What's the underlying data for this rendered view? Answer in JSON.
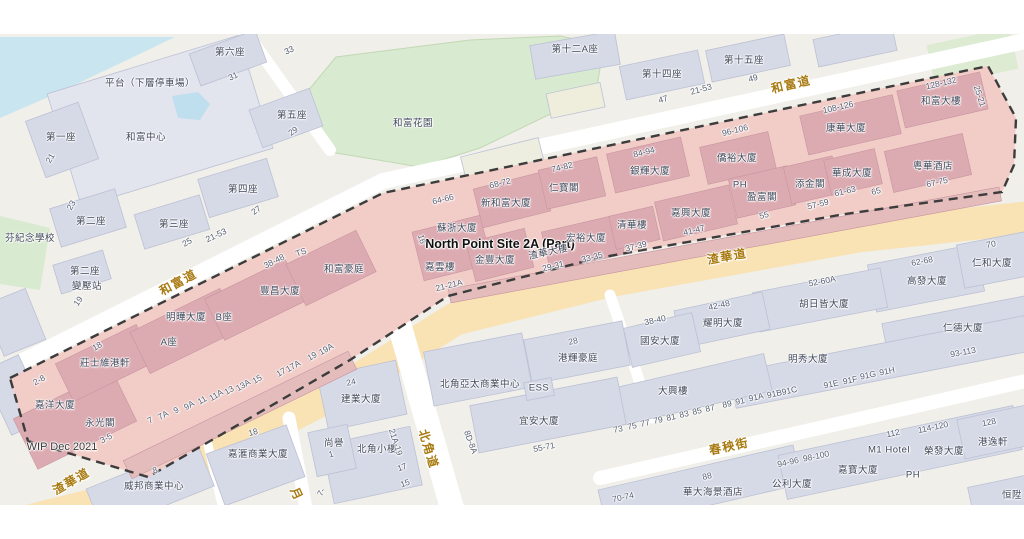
{
  "site": {
    "name": "North Point Site 2A (Part)",
    "wip_note": "WIP Dec 2021"
  },
  "colors": {
    "site_fill": "#f2cdc7",
    "site_building": "#dcabb1",
    "boundary_dash": "#3c3c3c",
    "road_label": "#a87a10",
    "building_label": "#3f4759",
    "main_road": "#f9e2b3",
    "water": "#c9e6f0",
    "park": "#d8eacf",
    "building": "#d6d9e6"
  },
  "roads": [
    {
      "t": "和富道",
      "x": 178,
      "y": 282,
      "r": -28,
      "c": "r"
    },
    {
      "t": "和富道",
      "x": 791,
      "y": 84,
      "r": -13,
      "c": "r"
    },
    {
      "t": "渣華道",
      "x": 71,
      "y": 481,
      "r": -30,
      "c": "r"
    },
    {
      "t": "渣華道",
      "x": 727,
      "y": 256,
      "r": -10,
      "c": "r"
    },
    {
      "t": "北角道",
      "x": 429,
      "y": 449,
      "r": 73,
      "c": "r"
    },
    {
      "t": "春秧街",
      "x": 729,
      "y": 446,
      "r": -12,
      "c": "r"
    },
    {
      "t": "月",
      "x": 297,
      "y": 494,
      "r": 65,
      "c": "r"
    }
  ],
  "buildings": [
    {
      "t": "第一座",
      "x": 61,
      "y": 136,
      "r": 0,
      "c": "b"
    },
    {
      "t": "和富中心",
      "x": 146,
      "y": 136,
      "r": 0,
      "c": "b"
    },
    {
      "t": "平台（下層停車場）",
      "x": 150,
      "y": 82,
      "r": 0,
      "c": "b"
    },
    {
      "t": "第六座",
      "x": 230,
      "y": 51,
      "r": 0,
      "c": "b"
    },
    {
      "t": "第五座",
      "x": 292,
      "y": 114,
      "r": 0,
      "c": "b"
    },
    {
      "t": "第四座",
      "x": 243,
      "y": 188,
      "r": 0,
      "c": "b"
    },
    {
      "t": "第二座",
      "x": 91,
      "y": 220,
      "r": 0,
      "c": "b"
    },
    {
      "t": "第三座",
      "x": 174,
      "y": 223,
      "r": 0,
      "c": "b"
    },
    {
      "t": "芬紀念學校",
      "x": 30,
      "y": 237,
      "r": 0,
      "c": "b"
    },
    {
      "t": "第二座",
      "x": 85,
      "y": 270,
      "r": 0,
      "c": "b"
    },
    {
      "t": "變壓站",
      "x": 87,
      "y": 285,
      "r": 0,
      "c": "b"
    },
    {
      "t": "和富花園",
      "x": 413,
      "y": 122,
      "r": 0,
      "c": "b"
    },
    {
      "t": "第十二A座",
      "x": 575,
      "y": 48,
      "r": 0,
      "c": "b"
    },
    {
      "t": "第十四座",
      "x": 662,
      "y": 73,
      "r": 0,
      "c": "b"
    },
    {
      "t": "第十五座",
      "x": 744,
      "y": 59,
      "r": 0,
      "c": "b"
    },
    {
      "t": "康華大廈",
      "x": 846,
      "y": 127,
      "r": 0,
      "c": "b"
    },
    {
      "t": "和富大樓",
      "x": 941,
      "y": 100,
      "r": 0,
      "c": "b"
    },
    {
      "t": "粵華酒店",
      "x": 933,
      "y": 165,
      "r": 0,
      "c": "b"
    },
    {
      "t": "僑裕大廈",
      "x": 737,
      "y": 157,
      "r": 0,
      "c": "b"
    },
    {
      "t": "銀輝大廈",
      "x": 650,
      "y": 170,
      "r": 0,
      "c": "b"
    },
    {
      "t": "仁寶閣",
      "x": 564,
      "y": 187,
      "r": 0,
      "c": "b"
    },
    {
      "t": "新和富大廈",
      "x": 506,
      "y": 202,
      "r": 0,
      "c": "b"
    },
    {
      "t": "蘇浙大廈",
      "x": 457,
      "y": 227,
      "r": 0,
      "c": "b"
    },
    {
      "t": "嘉雲樓",
      "x": 440,
      "y": 266,
      "r": 0,
      "c": "b"
    },
    {
      "t": "金豐大廈",
      "x": 495,
      "y": 259,
      "r": 0,
      "c": "b"
    },
    {
      "t": "渣華大樓",
      "x": 548,
      "y": 251,
      "r": -12,
      "c": "b"
    },
    {
      "t": "宏裕大廈",
      "x": 586,
      "y": 237,
      "r": 0,
      "c": "b"
    },
    {
      "t": "清華樓",
      "x": 632,
      "y": 224,
      "r": 0,
      "c": "b"
    },
    {
      "t": "嘉興大廈",
      "x": 691,
      "y": 212,
      "r": 0,
      "c": "b"
    },
    {
      "t": "PH",
      "x": 740,
      "y": 185,
      "r": 0,
      "c": "b"
    },
    {
      "t": "盈富閣",
      "x": 762,
      "y": 196,
      "r": 0,
      "c": "b"
    },
    {
      "t": "添金閣",
      "x": 810,
      "y": 183,
      "r": 0,
      "c": "b"
    },
    {
      "t": "華成大廈",
      "x": 852,
      "y": 172,
      "r": 0,
      "c": "b"
    },
    {
      "t": "豐昌大廈",
      "x": 280,
      "y": 290,
      "r": 0,
      "c": "b"
    },
    {
      "t": "和富豪庭",
      "x": 344,
      "y": 268,
      "r": 0,
      "c": "b"
    },
    {
      "t": "明曄大廈",
      "x": 186,
      "y": 316,
      "r": 0,
      "c": "b"
    },
    {
      "t": "B座",
      "x": 224,
      "y": 316,
      "r": 0,
      "c": "b"
    },
    {
      "t": "A座",
      "x": 169,
      "y": 341,
      "r": 0,
      "c": "b"
    },
    {
      "t": "莊士維港軒",
      "x": 105,
      "y": 362,
      "r": 0,
      "c": "b"
    },
    {
      "t": "嘉洋大廈",
      "x": 55,
      "y": 404,
      "r": 0,
      "c": "b"
    },
    {
      "t": "永光閣",
      "x": 100,
      "y": 422,
      "r": 0,
      "c": "b"
    },
    {
      "t": "建業大廈",
      "x": 361,
      "y": 398,
      "r": 0,
      "c": "b"
    },
    {
      "t": "北角亞太商業中心",
      "x": 480,
      "y": 383,
      "r": 0,
      "c": "b"
    },
    {
      "t": "ESS",
      "x": 539,
      "y": 388,
      "r": 0,
      "c": "b"
    },
    {
      "t": "港輝豪庭",
      "x": 578,
      "y": 357,
      "r": 0,
      "c": "b"
    },
    {
      "t": "宜安大廈",
      "x": 539,
      "y": 420,
      "r": 0,
      "c": "b"
    },
    {
      "t": "國安大廈",
      "x": 660,
      "y": 340,
      "r": 0,
      "c": "b"
    },
    {
      "t": "耀明大廈",
      "x": 723,
      "y": 322,
      "r": 0,
      "c": "b"
    },
    {
      "t": "胡日皆大廈",
      "x": 824,
      "y": 303,
      "r": 0,
      "c": "b"
    },
    {
      "t": "仁德大廈",
      "x": 963,
      "y": 327,
      "r": 0,
      "c": "b"
    },
    {
      "t": "高發大廈",
      "x": 927,
      "y": 280,
      "r": 0,
      "c": "b"
    },
    {
      "t": "仁和大廈",
      "x": 992,
      "y": 262,
      "r": 0,
      "c": "b"
    },
    {
      "t": "明秀大廈",
      "x": 808,
      "y": 358,
      "r": 0,
      "c": "b"
    },
    {
      "t": "大興樓",
      "x": 673,
      "y": 390,
      "r": 0,
      "c": "b"
    },
    {
      "t": "嘉滙商業大廈",
      "x": 258,
      "y": 453,
      "r": 0,
      "c": "b"
    },
    {
      "t": "威邦商業中心",
      "x": 154,
      "y": 485,
      "r": 0,
      "c": "b"
    },
    {
      "t": "尚譽",
      "x": 334,
      "y": 442,
      "r": 0,
      "c": "b"
    },
    {
      "t": "北角小樓",
      "x": 377,
      "y": 448,
      "r": 0,
      "c": "b"
    },
    {
      "t": "華大海景酒店",
      "x": 713,
      "y": 491,
      "r": 0,
      "c": "b"
    },
    {
      "t": "公利大廈",
      "x": 792,
      "y": 483,
      "r": 0,
      "c": "b"
    },
    {
      "t": "嘉寶大廈",
      "x": 858,
      "y": 469,
      "r": 0,
      "c": "b"
    },
    {
      "t": "M1 Hotel",
      "x": 889,
      "y": 450,
      "r": 0,
      "c": "b"
    },
    {
      "t": "榮發大廈",
      "x": 944,
      "y": 450,
      "r": 0,
      "c": "b"
    },
    {
      "t": "PH",
      "x": 913,
      "y": 475,
      "r": 0,
      "c": "b"
    },
    {
      "t": "港逸軒",
      "x": 993,
      "y": 441,
      "r": 0,
      "c": "b"
    },
    {
      "t": "恒陞",
      "x": 1012,
      "y": 494,
      "r": 0,
      "c": "b"
    }
  ],
  "numbers": [
    {
      "t": "33",
      "x": 289,
      "y": 50,
      "r": -25,
      "c": "n"
    },
    {
      "t": "31",
      "x": 233,
      "y": 76,
      "r": -25,
      "c": "n"
    },
    {
      "t": "21",
      "x": 50,
      "y": 158,
      "r": -60,
      "c": "n"
    },
    {
      "t": "29",
      "x": 293,
      "y": 131,
      "r": -35,
      "c": "n"
    },
    {
      "t": "23",
      "x": 71,
      "y": 205,
      "r": -60,
      "c": "n"
    },
    {
      "t": "27",
      "x": 256,
      "y": 210,
      "r": -35,
      "c": "n"
    },
    {
      "t": "25",
      "x": 187,
      "y": 242,
      "r": -30,
      "c": "n"
    },
    {
      "t": "21-53",
      "x": 216,
      "y": 235,
      "r": -25,
      "c": "n"
    },
    {
      "t": "19",
      "x": 78,
      "y": 301,
      "r": -55,
      "c": "n"
    },
    {
      "t": "47",
      "x": 663,
      "y": 99,
      "r": -15,
      "c": "n"
    },
    {
      "t": "21-53",
      "x": 701,
      "y": 89,
      "r": -15,
      "c": "n"
    },
    {
      "t": "49",
      "x": 753,
      "y": 78,
      "r": -15,
      "c": "n"
    },
    {
      "t": "96-106",
      "x": 735,
      "y": 130,
      "r": -14,
      "c": "n"
    },
    {
      "t": "108-126",
      "x": 838,
      "y": 107,
      "r": -13,
      "c": "n"
    },
    {
      "t": "128-132",
      "x": 941,
      "y": 83,
      "r": -13,
      "c": "n"
    },
    {
      "t": "25-21",
      "x": 980,
      "y": 96,
      "r": 72,
      "c": "n"
    },
    {
      "t": "67-75",
      "x": 937,
      "y": 182,
      "r": -12,
      "c": "n"
    },
    {
      "t": "65",
      "x": 876,
      "y": 191,
      "r": -14,
      "c": "n"
    },
    {
      "t": "61-63",
      "x": 845,
      "y": 191,
      "r": -14,
      "c": "n"
    },
    {
      "t": "57-59",
      "x": 818,
      "y": 204,
      "r": -14,
      "c": "n"
    },
    {
      "t": "55",
      "x": 764,
      "y": 215,
      "r": -14,
      "c": "n"
    },
    {
      "t": "41-47",
      "x": 694,
      "y": 230,
      "r": -14,
      "c": "n"
    },
    {
      "t": "37-39",
      "x": 636,
      "y": 246,
      "r": -14,
      "c": "n"
    },
    {
      "t": "33-35",
      "x": 592,
      "y": 257,
      "r": -14,
      "c": "n"
    },
    {
      "t": "29-31",
      "x": 553,
      "y": 266,
      "r": -14,
      "c": "n"
    },
    {
      "t": "21-21A",
      "x": 449,
      "y": 285,
      "r": -14,
      "c": "n"
    },
    {
      "t": "16",
      "x": 422,
      "y": 239,
      "r": 75,
      "c": "n"
    },
    {
      "t": "64-66",
      "x": 443,
      "y": 199,
      "r": -14,
      "c": "n"
    },
    {
      "t": "68-72",
      "x": 500,
      "y": 183,
      "r": -14,
      "c": "n"
    },
    {
      "t": "74-82",
      "x": 562,
      "y": 167,
      "r": -14,
      "c": "n"
    },
    {
      "t": "84-94",
      "x": 644,
      "y": 152,
      "r": -14,
      "c": "n"
    },
    {
      "t": "38-48",
      "x": 274,
      "y": 261,
      "r": -27,
      "c": "n"
    },
    {
      "t": "TS",
      "x": 301,
      "y": 252,
      "r": -20,
      "c": "n"
    },
    {
      "t": "2-8",
      "x": 39,
      "y": 380,
      "r": -30,
      "c": "n"
    },
    {
      "t": "3-5",
      "x": 106,
      "y": 438,
      "r": -27,
      "c": "n"
    },
    {
      "t": "18",
      "x": 97,
      "y": 346,
      "r": -30,
      "c": "n"
    },
    {
      "t": "7",
      "x": 150,
      "y": 420,
      "r": -30,
      "c": "n"
    },
    {
      "t": "7A",
      "x": 163,
      "y": 415,
      "r": -30,
      "c": "n"
    },
    {
      "t": "9",
      "x": 176,
      "y": 410,
      "r": -30,
      "c": "n"
    },
    {
      "t": "9A",
      "x": 189,
      "y": 405,
      "r": -30,
      "c": "n"
    },
    {
      "t": "11",
      "x": 202,
      "y": 400,
      "r": -30,
      "c": "n"
    },
    {
      "t": "11A",
      "x": 216,
      "y": 395,
      "r": -30,
      "c": "n"
    },
    {
      "t": "13",
      "x": 229,
      "y": 390,
      "r": -30,
      "c": "n"
    },
    {
      "t": "13A",
      "x": 243,
      "y": 385,
      "r": -30,
      "c": "n"
    },
    {
      "t": "15",
      "x": 257,
      "y": 379,
      "r": -30,
      "c": "n"
    },
    {
      "t": "17",
      "x": 281,
      "y": 372,
      "r": -30,
      "c": "n"
    },
    {
      "t": "17A",
      "x": 293,
      "y": 366,
      "r": -30,
      "c": "n"
    },
    {
      "t": "19",
      "x": 312,
      "y": 356,
      "r": -30,
      "c": "n"
    },
    {
      "t": "19A",
      "x": 326,
      "y": 349,
      "r": -30,
      "c": "n"
    },
    {
      "t": "24",
      "x": 351,
      "y": 382,
      "r": -12,
      "c": "n"
    },
    {
      "t": "28",
      "x": 573,
      "y": 341,
      "r": -12,
      "c": "n"
    },
    {
      "t": "8D-8A",
      "x": 471,
      "y": 442,
      "r": 70,
      "c": "n"
    },
    {
      "t": "55-71",
      "x": 544,
      "y": 447,
      "r": -11,
      "c": "n"
    },
    {
      "t": "21A-19",
      "x": 396,
      "y": 442,
      "r": 72,
      "c": "n"
    },
    {
      "t": "17",
      "x": 402,
      "y": 467,
      "r": -20,
      "c": "n"
    },
    {
      "t": "15",
      "x": 405,
      "y": 483,
      "r": -20,
      "c": "n"
    },
    {
      "t": "18",
      "x": 253,
      "y": 432,
      "r": -15,
      "c": "n"
    },
    {
      "t": "8",
      "x": 155,
      "y": 470,
      "r": -20,
      "c": "n"
    },
    {
      "t": "1",
      "x": 331,
      "y": 454,
      "r": -15,
      "c": "n"
    },
    {
      "t": "7-",
      "x": 321,
      "y": 492,
      "r": -60,
      "c": "n"
    },
    {
      "t": "38-40",
      "x": 655,
      "y": 320,
      "r": -12,
      "c": "n"
    },
    {
      "t": "42-48",
      "x": 719,
      "y": 305,
      "r": -12,
      "c": "n"
    },
    {
      "t": "52-60A",
      "x": 822,
      "y": 281,
      "r": -11,
      "c": "n"
    },
    {
      "t": "62-68",
      "x": 922,
      "y": 261,
      "r": -11,
      "c": "n"
    },
    {
      "t": "70",
      "x": 991,
      "y": 244,
      "r": -11,
      "c": "n"
    },
    {
      "t": "93-113",
      "x": 963,
      "y": 352,
      "r": -11,
      "c": "n"
    },
    {
      "t": "73",
      "x": 618,
      "y": 429,
      "r": -12,
      "c": "n"
    },
    {
      "t": "75",
      "x": 632,
      "y": 426,
      "r": -12,
      "c": "n"
    },
    {
      "t": "77",
      "x": 645,
      "y": 423,
      "r": -12,
      "c": "n"
    },
    {
      "t": "79",
      "x": 658,
      "y": 420,
      "r": -12,
      "c": "n"
    },
    {
      "t": "81",
      "x": 671,
      "y": 417,
      "r": -12,
      "c": "n"
    },
    {
      "t": "83",
      "x": 684,
      "y": 414,
      "r": -12,
      "c": "n"
    },
    {
      "t": "85",
      "x": 697,
      "y": 411,
      "r": -12,
      "c": "n"
    },
    {
      "t": "87",
      "x": 710,
      "y": 408,
      "r": -12,
      "c": "n"
    },
    {
      "t": "89",
      "x": 727,
      "y": 404,
      "r": -12,
      "c": "n"
    },
    {
      "t": "91",
      "x": 740,
      "y": 401,
      "r": -12,
      "c": "n"
    },
    {
      "t": "91A",
      "x": 756,
      "y": 397,
      "r": -12,
      "c": "n"
    },
    {
      "t": "91B91C",
      "x": 782,
      "y": 392,
      "r": -12,
      "c": "n"
    },
    {
      "t": "91E",
      "x": 831,
      "y": 384,
      "r": -12,
      "c": "n"
    },
    {
      "t": "91F",
      "x": 850,
      "y": 380,
      "r": -12,
      "c": "n"
    },
    {
      "t": "91G",
      "x": 868,
      "y": 375,
      "r": -12,
      "c": "n"
    },
    {
      "t": "91H",
      "x": 887,
      "y": 371,
      "r": -12,
      "c": "n"
    },
    {
      "t": "88",
      "x": 707,
      "y": 476,
      "r": -12,
      "c": "n"
    },
    {
      "t": "70-74",
      "x": 623,
      "y": 497,
      "r": -12,
      "c": "n"
    },
    {
      "t": "94-96",
      "x": 788,
      "y": 462,
      "r": -12,
      "c": "n"
    },
    {
      "t": "98-100",
      "x": 816,
      "y": 456,
      "r": -12,
      "c": "n"
    },
    {
      "t": "112",
      "x": 893,
      "y": 433,
      "r": -12,
      "c": "n"
    },
    {
      "t": "114-120",
      "x": 933,
      "y": 427,
      "r": -12,
      "c": "n"
    },
    {
      "t": "128",
      "x": 989,
      "y": 422,
      "r": -12,
      "c": "n"
    }
  ]
}
